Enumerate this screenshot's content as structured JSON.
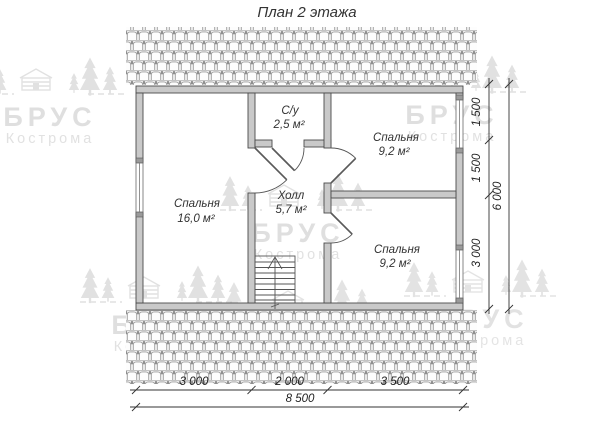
{
  "title": "План 2 этажа",
  "watermark": {
    "brand": "БРУС",
    "city": "Кострома"
  },
  "rooms": [
    {
      "id": "bedroom-left",
      "name": "Спальня",
      "area": "16,0 м²"
    },
    {
      "id": "bathroom",
      "name": "С/у",
      "area": "2,5 м²"
    },
    {
      "id": "hall",
      "name": "Холл",
      "area": "5,7 м²"
    },
    {
      "id": "bedroom-top-right",
      "name": "Спальня",
      "area": "9,2 м²"
    },
    {
      "id": "bedroom-bottom-right",
      "name": "Спальня",
      "area": "9,2 м²"
    }
  ],
  "dimensions": {
    "bottom_segments": [
      "3 000",
      "2 000",
      "3 500"
    ],
    "bottom_total": "8 500",
    "right_segments": [
      "1 500",
      "1 500",
      "3 000"
    ],
    "right_total": "6 000"
  }
}
